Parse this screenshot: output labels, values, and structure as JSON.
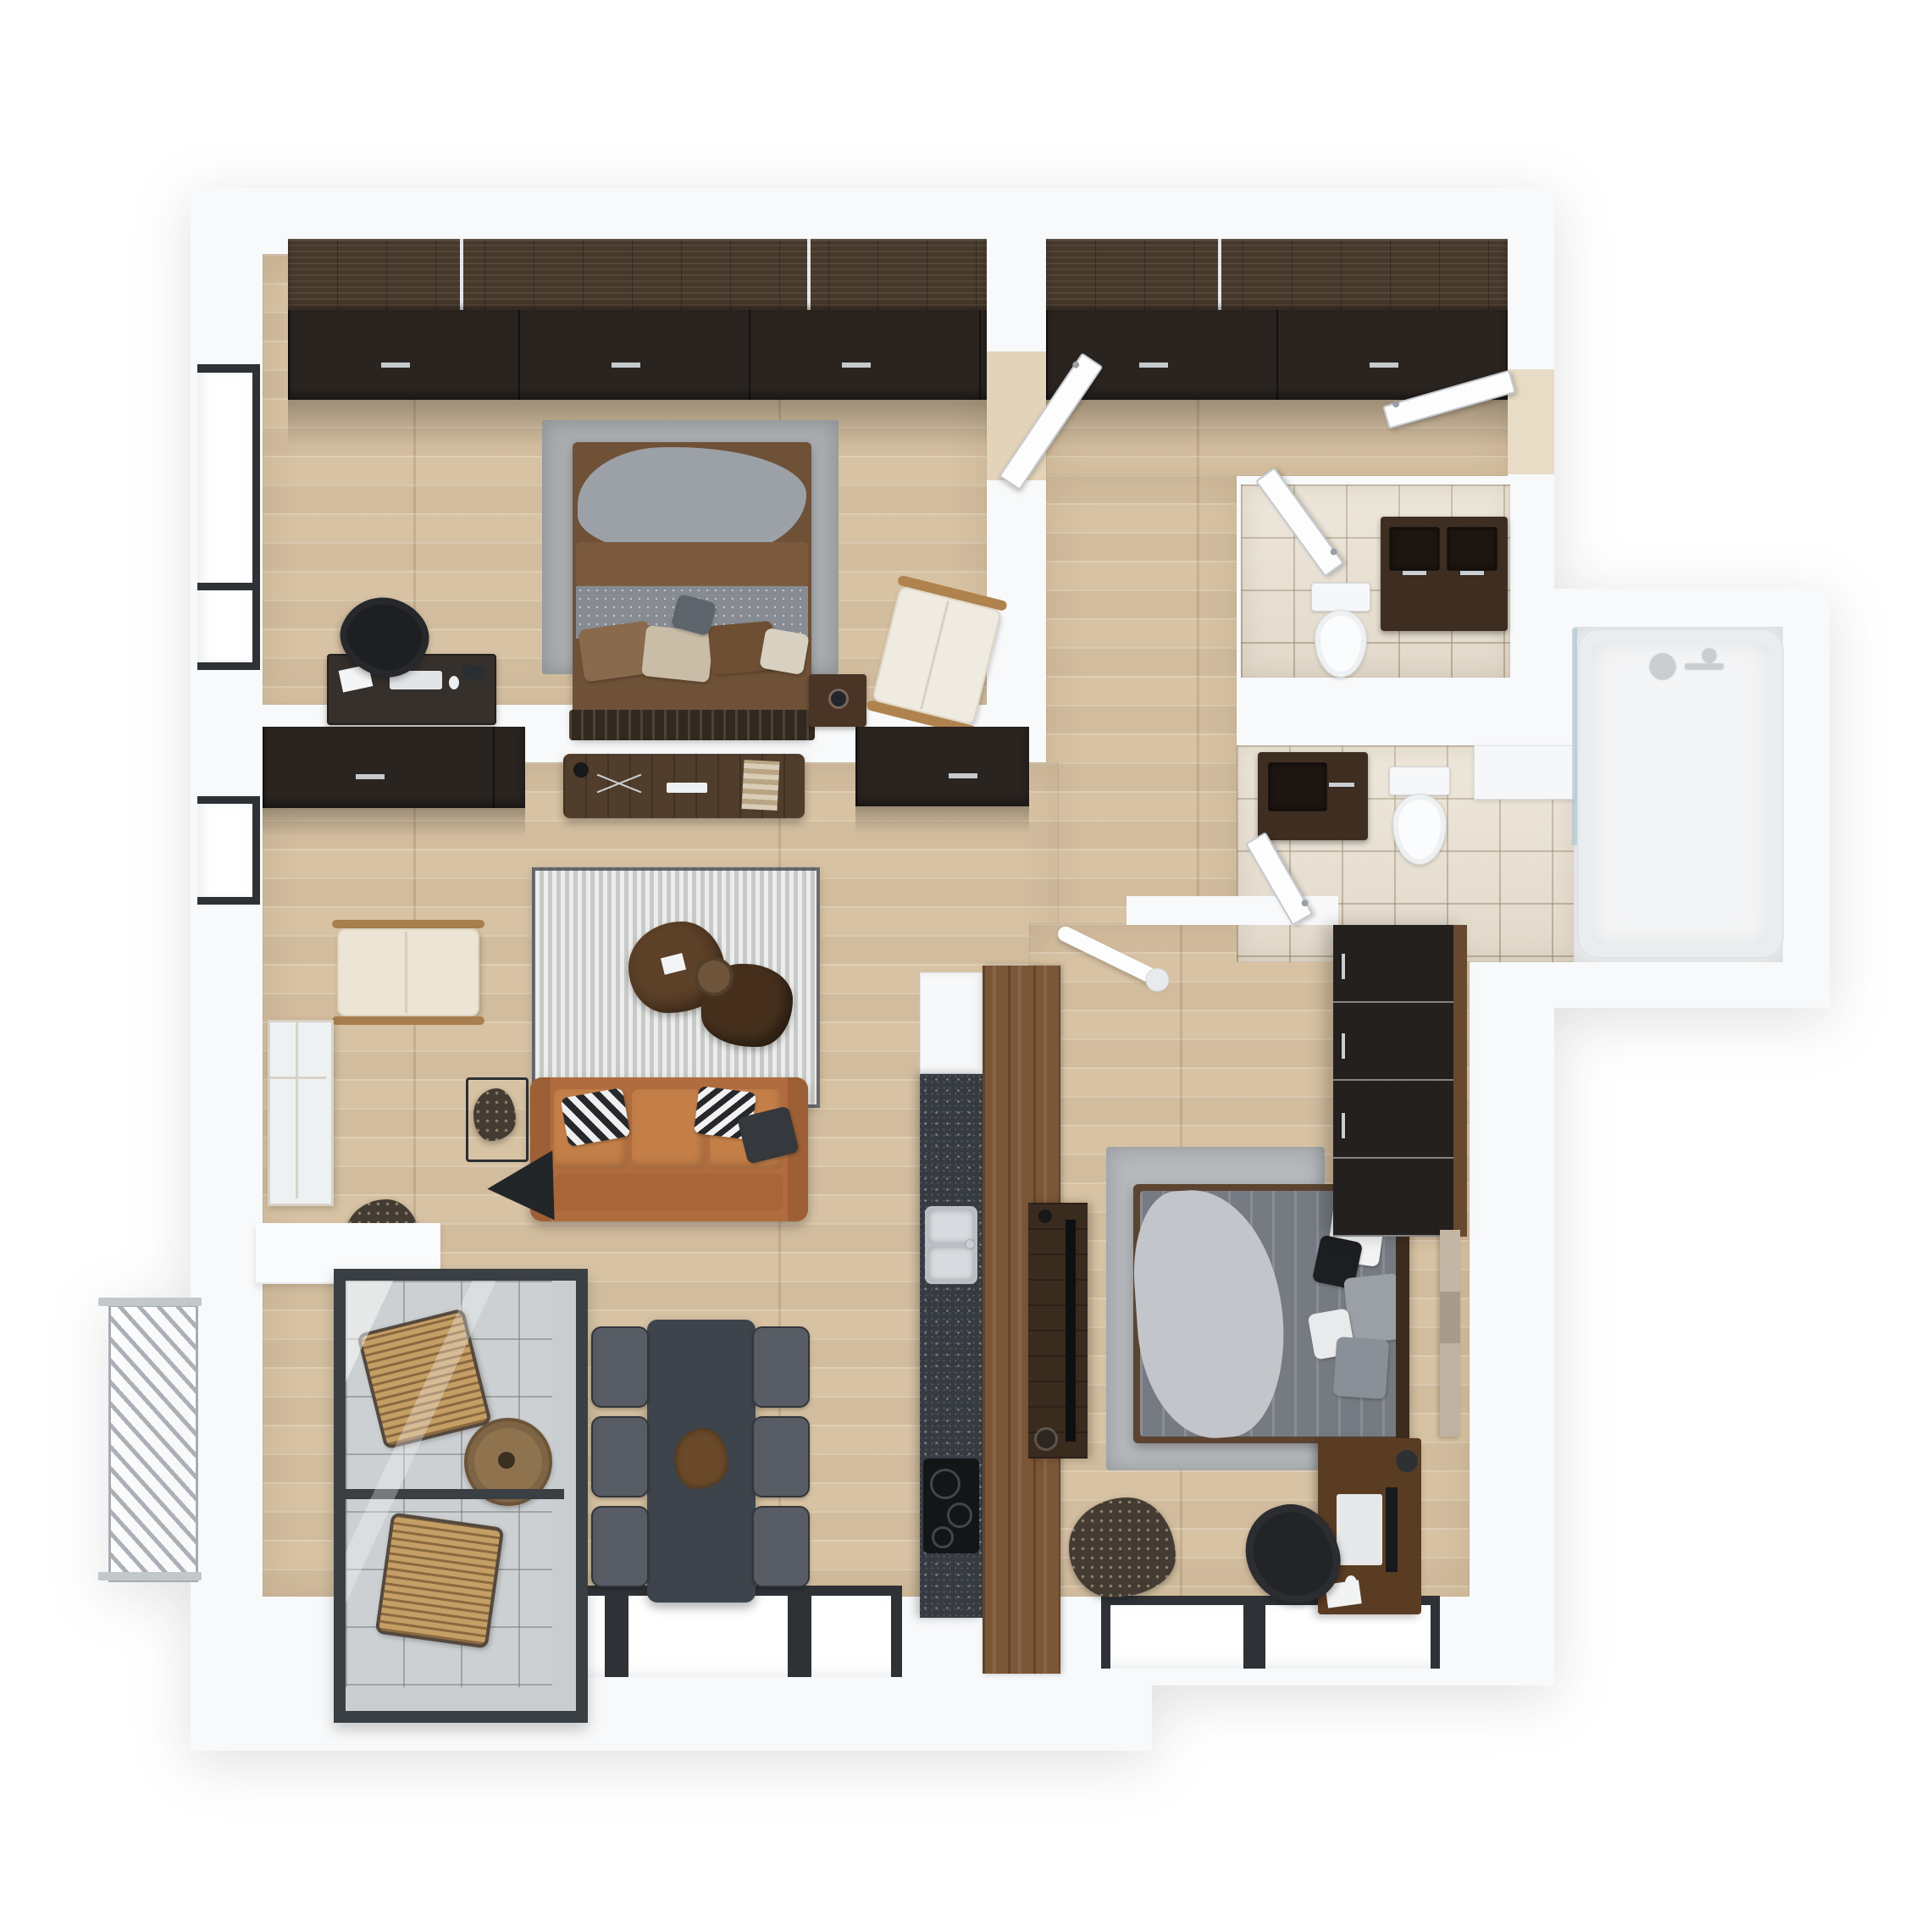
{
  "scene": {
    "title": "Top-down 3D render of a two-bedroom apartment floor plan",
    "view": "top-down axonometric",
    "no_visible_text": true
  },
  "palette": {
    "bg": "#ffffff",
    "wall": "#f8f9fa",
    "wood-floor": "#ddc9ab",
    "tile-beige": "#e9e0d1",
    "tile-gray": "#ccd0d2",
    "cab-wood": "#46382a",
    "cab-front": "#2a2420",
    "panel-wood": "#7c5737",
    "counter": "#363b41",
    "sofa": "#b06c3e",
    "rug": "#d6d8d6",
    "dining-table": "#3e444c",
    "frame-dark": "#2e3236",
    "metal": "#a6acb2"
  },
  "rooms": [
    {
      "id": "bedroom-1",
      "label": "Bedroom 1 with wardrobe, double bed, desk and lounge chair"
    },
    {
      "id": "hallway",
      "label": "Entrance hallway with full-width wardrobe"
    },
    {
      "id": "wc",
      "label": "Guest WC with double vanity and toilet"
    },
    {
      "id": "bathroom",
      "label": "Bathroom with vanity, toilet, washer and bathtub"
    },
    {
      "id": "living-room",
      "label": "Open living room with kitchen and dining area"
    },
    {
      "id": "bedroom-2",
      "label": "Bedroom 2 with double bed, wardrobe and desk"
    },
    {
      "id": "loggia",
      "label": "Glazed loggia with wicker chairs and coffee table"
    },
    {
      "id": "balcony",
      "label": "Open balcony with metal railing"
    }
  ],
  "furniture": {
    "bedroom1": [
      "wardrobe",
      "double-bed",
      "area-rug",
      "nightstand",
      "desk",
      "office-chair",
      "lounge-chair",
      "window"
    ],
    "hallway": [
      "wardrobe",
      "entry-door",
      "interior-doors"
    ],
    "wc": [
      "double-vanity",
      "toilet"
    ],
    "bathroom": [
      "vanity",
      "toilet",
      "washer-counter",
      "bathtub",
      "shower-fittings"
    ],
    "living": [
      "tv-console",
      "wall-cabinets",
      "area-rug",
      "coffee-tables",
      "leather-sofa",
      "floor-lamp",
      "cream-armchair",
      "side-table",
      "plants",
      "dining-table",
      "six-chairs",
      "kitchen-counter",
      "sink",
      "cooktop",
      "fridge",
      "wood-partition",
      "leaning-mirror"
    ],
    "bedroom2": [
      "wardrobe",
      "double-bed",
      "area-rug",
      "tv-dresser",
      "desk",
      "chair",
      "plant",
      "artwork",
      "ceiling-lamp"
    ],
    "loggia": [
      "wicker-chair",
      "round-table",
      "wicker-chair"
    ],
    "balcony": [
      "metal-railing"
    ]
  }
}
